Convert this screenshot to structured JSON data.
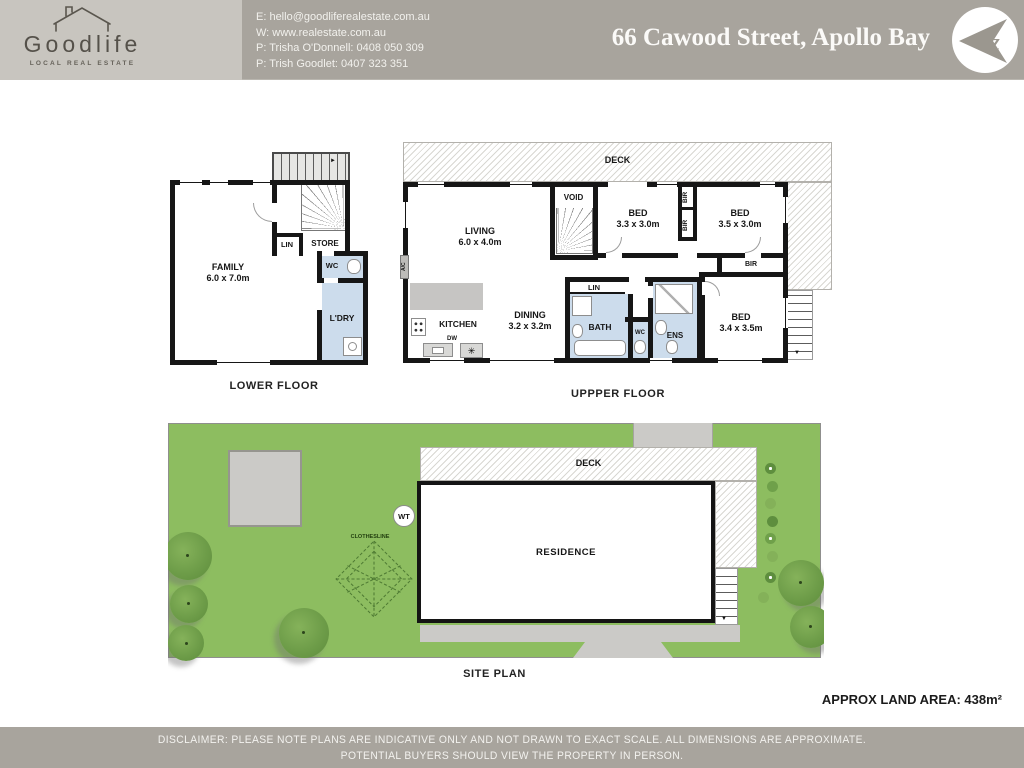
{
  "header": {
    "brand": "Goodlife",
    "brand_tagline": "LOCAL REAL ESTATE",
    "contact_lines": [
      "E: hello@goodliferealestate.com.au",
      "W: www.realestate.com.au",
      "P: Trisha O'Donnell: 0408 050 309",
      "P: Trish Goodlet: 0407 323 351"
    ],
    "address": "66 Cawood Street, Apollo Bay",
    "compass_letter": "z"
  },
  "lower_floor": {
    "title": "LOWER FLOOR",
    "family_name": "FAMILY",
    "family_dims": "6.0 x 7.0m",
    "lin": "LIN",
    "store": "STORE",
    "wc": "WC",
    "laundry": "L'DRY"
  },
  "upper_floor": {
    "title": "UPPPER FLOOR",
    "deck": "DECK",
    "living_name": "LIVING",
    "living_dims": "6.0 x 4.0m",
    "void": "VOID",
    "bed1_name": "BED",
    "bed1_dims": "3.3 x 3.0m",
    "bed2_name": "BED",
    "bed2_dims": "3.5 x 3.0m",
    "bed3_name": "BED",
    "bed3_dims": "3.4 x 3.5m",
    "bir": "BIR",
    "kitchen": "KITCHEN",
    "dw": "DW",
    "dining_name": "DINING",
    "dining_dims": "3.2 x 3.2m",
    "lin": "LIN",
    "bath": "BATH",
    "wc": "WC",
    "ens": "ENS",
    "ac": "A/C"
  },
  "site_plan": {
    "title": "SITE PLAN",
    "deck": "DECK",
    "residence": "RESIDENCE",
    "water_tank": "WT",
    "clothesline": "CLOTHESLINE"
  },
  "summary": {
    "land_area": "APPROX LAND AREA: 438m²"
  },
  "footer": {
    "line1": "DISCLAIMER: PLEASE NOTE PLANS ARE INDICATIVE ONLY AND NOT DRAWN TO EXACT SCALE. ALL DIMENSIONS ARE APPROXIMATE.",
    "line2": "POTENTIAL BUYERS SHOULD VIEW THE PROPERTY IN PERSON."
  },
  "icons": {
    "stair_down_arrow": "▼",
    "stair_right_arrow": "►",
    "appliance_star": "✳"
  },
  "colors": {
    "header_left_bg": "#c8c5bf",
    "header_bg": "#a8a49d",
    "wall": "#161616",
    "wet_area_blue": "#ccdcec",
    "lawn_green": "#8dbd60",
    "tree_green": "#6e9d49",
    "path_gray": "#cbcac7",
    "counter_gray": "#c6c5c3"
  }
}
